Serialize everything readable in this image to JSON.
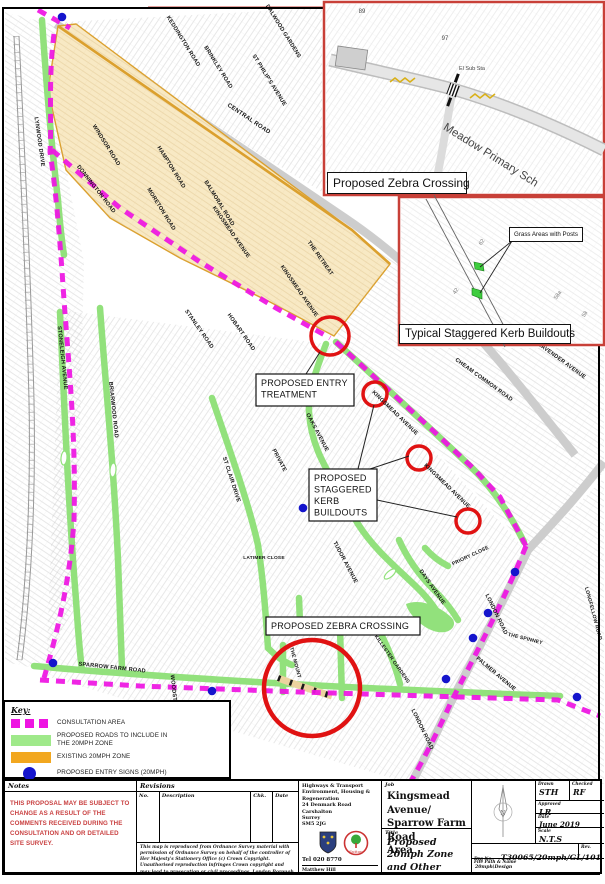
{
  "colors": {
    "consultation": "#ee14e2",
    "green_road": "#92e17c",
    "green_legend": "#9fe98a",
    "orange_zone_fill": "#f8e9c4",
    "orange_zone_edge": "#dba02e",
    "orange_legend": "#f2a71f",
    "blue_sign": "#1414cc",
    "red_highlight": "#e01212",
    "inset_border": "#c84038",
    "grey_road": "#cdcdcd",
    "notes_red": "#c94040"
  },
  "legend": {
    "title": "Key:",
    "items": [
      {
        "type": "consultation",
        "label": "CONSULTATION AREA"
      },
      {
        "type": "roads",
        "label": "PROPOSED ROADS TO INCLUDE IN THE 20MPH ZONE"
      },
      {
        "type": "zone",
        "label": "EXISTING 20MPH ZONE"
      },
      {
        "type": "signs",
        "label": "PROPOSED ENTRY SIGNS (20MPH)"
      }
    ]
  },
  "insets": {
    "zebra": {
      "caption": "Proposed Zebra Crossing",
      "texts": [
        {
          "t": "89",
          "x": 362,
          "y": 13,
          "r": 0,
          "fs": 6
        },
        {
          "t": "97",
          "x": 445,
          "y": 40,
          "r": 0,
          "fs": 6
        },
        {
          "t": "El Sub Sta",
          "x": 472,
          "y": 70,
          "r": 0,
          "fs": 5.5
        },
        {
          "t": "Meadow Primary Sch",
          "x": 489,
          "y": 158,
          "r": 32,
          "fs": 11.5
        }
      ]
    },
    "kerb": {
      "caption": "Typical Staggered Kerb Buildouts",
      "callout": "Grass Areas with Posts",
      "texts": [
        {
          "t": "62",
          "x": 483,
          "y": 243,
          "r": -55,
          "fs": 5.5
        },
        {
          "t": "42",
          "x": 457,
          "y": 292,
          "r": -55,
          "fs": 5.5
        },
        {
          "t": "58a",
          "x": 559,
          "y": 296,
          "r": -55,
          "fs": 5.5
        },
        {
          "t": "58",
          "x": 586,
          "y": 315,
          "r": -55,
          "fs": 5.5
        }
      ]
    }
  },
  "map": {
    "annotations": [
      {
        "lines": [
          "PROPOSED ENTRY",
          "TREATMENT"
        ],
        "x": 256,
        "y": 374,
        "w": 98,
        "h": 32,
        "leaders": [
          [
            306,
            374,
            320,
            352
          ]
        ]
      },
      {
        "lines": [
          "PROPOSED",
          "STAGGERED",
          "KERB",
          "BUILDOUTS"
        ],
        "x": 309,
        "y": 469,
        "w": 68,
        "h": 52,
        "leaders": [
          [
            358,
            469,
            374,
            405
          ],
          [
            370,
            469,
            409,
            456
          ],
          [
            377,
            500,
            457,
            517
          ]
        ]
      },
      {
        "lines": [
          "PROPOSED ZEBRA CROSSING"
        ],
        "x": 266,
        "y": 617,
        "w": 154,
        "h": 18,
        "leaders": []
      }
    ],
    "street_labels": [
      {
        "t": "CENTRAL ROAD",
        "x": 248,
        "y": 120,
        "r": 34,
        "fs": 6
      },
      {
        "t": "KEDDINGTON ROAD",
        "x": 182,
        "y": 42,
        "r": 58
      },
      {
        "t": "BRINKLEY ROAD",
        "x": 217,
        "y": 68,
        "r": 58
      },
      {
        "t": "DALWOOD GARDENS",
        "x": 282,
        "y": 32,
        "r": 58
      },
      {
        "t": "ST PHILIP'S AVENUE",
        "x": 268,
        "y": 81,
        "r": 58
      },
      {
        "t": "LYNWOOD DRIVE",
        "x": 38,
        "y": 142,
        "r": 82
      },
      {
        "t": "WINDSOR ROAD",
        "x": 105,
        "y": 146,
        "r": 58
      },
      {
        "t": "HAMPTON ROAD",
        "x": 170,
        "y": 168,
        "r": 58
      },
      {
        "t": "MORETON ROAD",
        "x": 160,
        "y": 210,
        "r": 58
      },
      {
        "t": "DONNINGTON ROAD",
        "x": 95,
        "y": 190,
        "r": 52
      },
      {
        "t": "BALMORAL ROAD",
        "x": 218,
        "y": 204,
        "r": 58
      },
      {
        "t": "KINGSMEAD AVENUE",
        "x": 230,
        "y": 233,
        "r": 55
      },
      {
        "t": "THE RETREAT",
        "x": 319,
        "y": 259,
        "r": 55
      },
      {
        "t": "KINGSMEAD AVENUE",
        "x": 298,
        "y": 292,
        "r": 55
      },
      {
        "t": "HOBART ROAD",
        "x": 240,
        "y": 333,
        "r": 55
      },
      {
        "t": "STANLEY ROAD",
        "x": 198,
        "y": 330,
        "r": 55
      },
      {
        "t": "STONELEIGH AVENUE",
        "x": 61,
        "y": 358,
        "r": 84
      },
      {
        "t": "BRIARWOOD ROAD",
        "x": 112,
        "y": 410,
        "r": 84
      },
      {
        "t": "ST CLAIR DRIVE",
        "x": 230,
        "y": 480,
        "r": 72
      },
      {
        "t": "PRIVATE",
        "x": 278,
        "y": 461,
        "r": 62
      },
      {
        "t": "OAKS AVENUE",
        "x": 316,
        "y": 433,
        "r": 62
      },
      {
        "t": "TUDOR AVENUE",
        "x": 344,
        "y": 563,
        "r": 62
      },
      {
        "t": "LATIMER CLOSE",
        "x": 264,
        "y": 559,
        "r": 0,
        "fs": 4.8
      },
      {
        "t": "KINGSMEAD AVENUE",
        "x": 394,
        "y": 414,
        "r": 44
      },
      {
        "t": "KINGSMEAD AVENUE",
        "x": 446,
        "y": 487,
        "r": 44
      },
      {
        "t": "CHEAM COMMON ROAD",
        "x": 483,
        "y": 381,
        "r": 36
      },
      {
        "t": "LAVENDER AVENUE",
        "x": 561,
        "y": 362,
        "r": 36
      },
      {
        "t": "LONDON ROAD",
        "x": 495,
        "y": 615,
        "r": 64
      },
      {
        "t": "LONDON ROAD",
        "x": 421,
        "y": 730,
        "r": 64
      },
      {
        "t": "PALMER AVENUE",
        "x": 495,
        "y": 675,
        "r": 40
      },
      {
        "t": "THE SPINNEY",
        "x": 525,
        "y": 640,
        "r": 14,
        "fs": 5
      },
      {
        "t": "DAYS AVENUE",
        "x": 431,
        "y": 588,
        "r": 55
      },
      {
        "t": "PRIORY CLOSE",
        "x": 471,
        "y": 557,
        "r": -25,
        "fs": 5
      },
      {
        "t": "LONGFELLOW ROAD",
        "x": 592,
        "y": 614,
        "r": 75,
        "fs": 5
      },
      {
        "t": "THE MOUNT",
        "x": 294,
        "y": 663,
        "r": 75,
        "fs": 5
      },
      {
        "t": "KILLESTER GARDENS",
        "x": 391,
        "y": 660,
        "r": 55,
        "fs": 5
      },
      {
        "t": "SPARROW FARM ROAD",
        "x": 112,
        "y": 669,
        "r": 6
      },
      {
        "t": "WOODSTONE AVENUE",
        "x": 174,
        "y": 707,
        "r": 84
      }
    ],
    "geometry": {
      "texture_zones": [
        {
          "d": "M5,12 L58,26 L68,180 L84,262 L76,600 L44,670 L5,662 Z",
          "p": "h1"
        },
        {
          "d": "M62,22 L322,8 L322,192 L250,148 Z",
          "p": "h2"
        },
        {
          "d": "M336,344 L528,548 L604,472 L604,348 L400,348 L400,266 L352,232 Z",
          "p": "h1"
        },
        {
          "d": "M60,310 L336,345 L524,548 L452,700 L412,784 L46,676 Z",
          "p": "h2"
        },
        {
          "d": "M530,552 L604,478 L604,784 L414,784 L455,700 Z",
          "p": "h1"
        }
      ],
      "grey_roads": [
        "M56,24 C150,86 260,160 345,218 C400,255 455,308 500,362 C530,398 555,430 575,455",
        "M604,462 C575,500 548,528 528,550 C505,597 478,650 452,700 C438,730 424,760 410,786"
      ],
      "railway": [
        "M14,36 C20,160 26,280 29,400 C31,500 26,590 17,660",
        "M19,36 C25,160 31,280 34,400 C36,500 31,590 22,660"
      ],
      "railway_ties": "M16,36 C22,160 28,280 31,400 C33,500 28,590 19,660",
      "red_top_line": "M148,7.5 L324,7.5",
      "existing_zone": "M58,26 L76,24 L352,230 L390,264 L334,336 L270,302 L180,258 L110,218 L66,170 L48,90 Z",
      "existing_zone_edge": "M58,26 L352,230 L390,264",
      "green_roads": [
        "M42,20 C46,80 52,150 58,200 C60,225 62,242 64,255",
        "M60,312 C64,400 68,500 76,600 C78,630 80,655 82,670",
        "M100,308 C106,390 114,470 118,560 C120,610 121,645 122,668",
        "M34,666 C120,674 300,686 460,692 C500,694 535,695 560,696",
        "M212,398 C226,440 248,500 258,545 C264,585 266,620 268,648",
        "M268,648 C276,656 282,661 292,665",
        "M326,344 C316,370 308,392 309,412 C311,442 322,462 336,486 C346,502 352,514 358,524",
        "M358,524 C372,546 390,562 406,577 C420,590 428,598 436,610",
        "M336,342 C380,382 430,428 470,466 C495,490 512,518 524,542",
        "M283,645 L283,692",
        "M299,598 L300,624",
        "M340,628 L342,698",
        "M382,636 C390,652 396,668 400,684",
        "M399,540 C408,560 420,576 434,590 C444,600 452,610 458,620",
        "M425,548 C432,556 440,562 448,566"
      ],
      "green_junction": "M406,604 C420,598 440,606 452,618 C458,626 450,634 438,632 C424,630 408,614 406,604",
      "green_ring": {
        "cx": 407,
        "cy": 627,
        "r": 6
      },
      "lozenges": [
        [
          64,
          458,
          5
        ],
        [
          113,
          470,
          5
        ],
        [
          390,
          574,
          50
        ]
      ],
      "consultation": [
        "M38,10 L70,28",
        "M54,34 C48,80 52,120 50,152 C56,190 60,240 64,300 C70,380 76,440 74,520 C70,580 58,630 44,678",
        "M52,150 L120,208 L200,262 L276,308 L330,338",
        "M336,342 L382,384 L428,426 L473,468 L500,497 L526,546",
        "M526,546 C505,598 478,650 452,700 C440,727 425,757 410,783",
        "M40,680 L140,686 L300,692 L460,697 L558,700 L600,716"
      ],
      "zebra_segment": "M278,678 C294,684 312,690 332,696",
      "red_circles": [
        [
          330,
          336,
          19,
          3.5
        ],
        [
          375,
          394,
          12,
          3.5
        ],
        [
          419,
          458,
          12,
          3.5
        ],
        [
          468,
          521,
          12,
          3.5
        ],
        [
          312,
          688,
          48,
          4.5
        ]
      ],
      "blue_dots": [
        [
          62,
          17
        ],
        [
          53,
          663
        ],
        [
          212,
          691
        ],
        [
          303,
          508
        ],
        [
          515,
          572
        ],
        [
          488,
          613
        ],
        [
          473,
          638
        ],
        [
          446,
          679
        ],
        [
          577,
          697
        ]
      ],
      "inset1": {
        "frame": [
          324,
          2,
          280,
          193
        ],
        "road": "M330,60 C380,72 420,80 456,90 C500,103 552,124 604,150",
        "side_road": "M452,94 C447,120 443,150 436,182",
        "zigzag1": "M390,82 l5,-4 5,4 5,-4 5,4 5,-4",
        "zigzag2": "M470,98 l5,-4 5,4 5,-4 5,4 5,-4",
        "building": [
          338,
          46,
          30,
          20
        ],
        "crossing": [
          453,
          90,
          20
        ]
      },
      "inset2": {
        "frame": [
          399,
          197,
          205,
          148
        ],
        "road": [
          "M426,199 L505,347",
          "M434,195 L513,343"
        ],
        "buildout1": "M474,262 l9,2 1,7 -9,-2 Z",
        "buildout2": "M472,288 l10,3 0,8 -10,-4 Z",
        "leaders": [
          [
            512,
            241,
            480,
            267
          ],
          [
            512,
            241,
            480,
            293
          ]
        ]
      }
    }
  },
  "title_block": {
    "notes_header": "Notes",
    "notes_text": "THIS PROPOSAL MAY BE SUBJECT TO CHANGE AS A RESULT OF THE COMMENTS RECEIVED DURING THE CONSULTATION AND OR DETAILED SITE SURVEY.",
    "revisions_header": "Revisions",
    "revisions_columns": [
      "No.",
      "Description",
      "Chk.",
      "Date"
    ],
    "copyright": "This map is reproduced from Ordnance Survey material with permission of Ordnance Survey on behalf of the controller of Her Majesty's Stationery Office (c) Crown Copyright. Unauthorised reproduction infringes Crown copyright and may lead to prosecution or civil proceedings. London Borough of Sutton 100008655 (2005)",
    "office_lines": [
      "Highways & Transport",
      "Environment, Housing & Regeneration",
      "24 Denmark Road",
      "Carshalton",
      "Surrey",
      "SM5 2JG"
    ],
    "tel": "Tel  020 8770",
    "officer_lines": [
      "Matthew Hill",
      "Assistant Director of Highways, Transport and",
      "Regulatory Services",
      "London Borough of Sutton"
    ],
    "sutton_label": "Sutton",
    "job_header": "Job",
    "job_text": "Kingsmead Avenue/\nSparrow Farm Road\nArea",
    "title_header": "Title",
    "title_text": "Proposed 20mph Zone\nand Other Measures\n(General Layout)",
    "north_label": "N",
    "drawn_label": "Drawn",
    "drawn": "STH",
    "checked_label": "Checked",
    "checked": "RF",
    "approved_label": "Approved",
    "approved": "LR",
    "date_label": "Date",
    "date": "June 2019",
    "scale_label": "Scale",
    "scale": "N.T.S",
    "drg_label": "Drg No.",
    "drg": "T30065/20mph/GL/101",
    "rev_label": "Rev.",
    "file_label": "File Path & Name",
    "file_value": "20mph\\Design"
  }
}
